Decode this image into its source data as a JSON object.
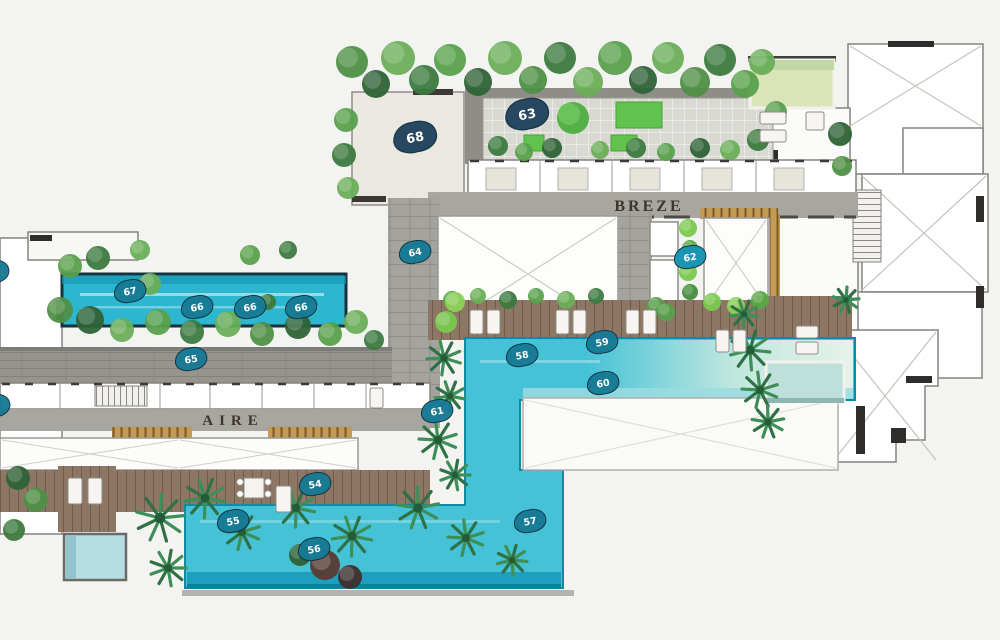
{
  "plan": {
    "type": "resort amenity deck floor plan",
    "area_labels": [
      {
        "id": "breze",
        "text": "BREZE",
        "x": 649,
        "y": 211,
        "size": 16,
        "spacing": 3
      },
      {
        "id": "aire",
        "text": "AIRE",
        "x": 233,
        "y": 425,
        "size": 15,
        "spacing": 6
      }
    ],
    "markers": [
      {
        "num": "68",
        "x": 415,
        "y": 137,
        "variant": "navy",
        "size": "large"
      },
      {
        "num": "63",
        "x": 527,
        "y": 114,
        "variant": "navy",
        "size": "large"
      },
      {
        "num": "64",
        "x": 415,
        "y": 252,
        "variant": "teal",
        "size": "normal"
      },
      {
        "num": "62",
        "x": 690,
        "y": 257,
        "variant": "cyan",
        "size": "normal"
      },
      {
        "num": "67",
        "x": 130,
        "y": 291,
        "variant": "teal",
        "size": "normal"
      },
      {
        "num": "66",
        "x": 197,
        "y": 307,
        "variant": "teal",
        "size": "normal"
      },
      {
        "num": "66",
        "x": 250,
        "y": 307,
        "variant": "teal",
        "size": "normal"
      },
      {
        "num": "66",
        "x": 301,
        "y": 307,
        "variant": "teal",
        "size": "normal"
      },
      {
        "num": "65",
        "x": 191,
        "y": 359,
        "variant": "teal",
        "size": "normal"
      },
      {
        "num": "58",
        "x": 522,
        "y": 355,
        "variant": "teal",
        "size": "normal"
      },
      {
        "num": "59",
        "x": 602,
        "y": 342,
        "variant": "teal",
        "size": "normal"
      },
      {
        "num": "60",
        "x": 603,
        "y": 383,
        "variant": "teal",
        "size": "normal"
      },
      {
        "num": "61",
        "x": 437,
        "y": 411,
        "variant": "teal",
        "size": "normal"
      },
      {
        "num": "54",
        "x": 315,
        "y": 484,
        "variant": "teal",
        "size": "normal"
      },
      {
        "num": "55",
        "x": 233,
        "y": 521,
        "variant": "teal",
        "size": "normal"
      },
      {
        "num": "56",
        "x": 314,
        "y": 549,
        "variant": "teal",
        "size": "normal"
      },
      {
        "num": "57",
        "x": 530,
        "y": 521,
        "variant": "teal",
        "size": "normal"
      },
      {
        "num": "",
        "x": -7,
        "y": 272,
        "variant": "teal",
        "size": "normal"
      },
      {
        "num": "",
        "x": -6,
        "y": 406,
        "variant": "teal",
        "size": "normal"
      }
    ],
    "colors": {
      "background": "#f3f3f1",
      "pool_water": "#45c2d6",
      "pool_edge": "#128aa6",
      "pool_dark_strip": "#1d9fbd",
      "lap_pool": "#2cb6d0",
      "pale_pool_blue": "#bfe0da",
      "pale_pool_green": "#d9e4b8",
      "beach_sand": "#e9f3e2",
      "marker_teal": "#177a94",
      "marker_navy": "#21425c",
      "marker_cyan": "#1593b4",
      "wood_deck": "#8d7663",
      "paver_gray": "#a2a09a",
      "corridor_gray": "#a8a6a0",
      "lawn_green": "#61c24d",
      "wall_line": "#85837e",
      "wall_black": "#2e2d2b"
    }
  }
}
